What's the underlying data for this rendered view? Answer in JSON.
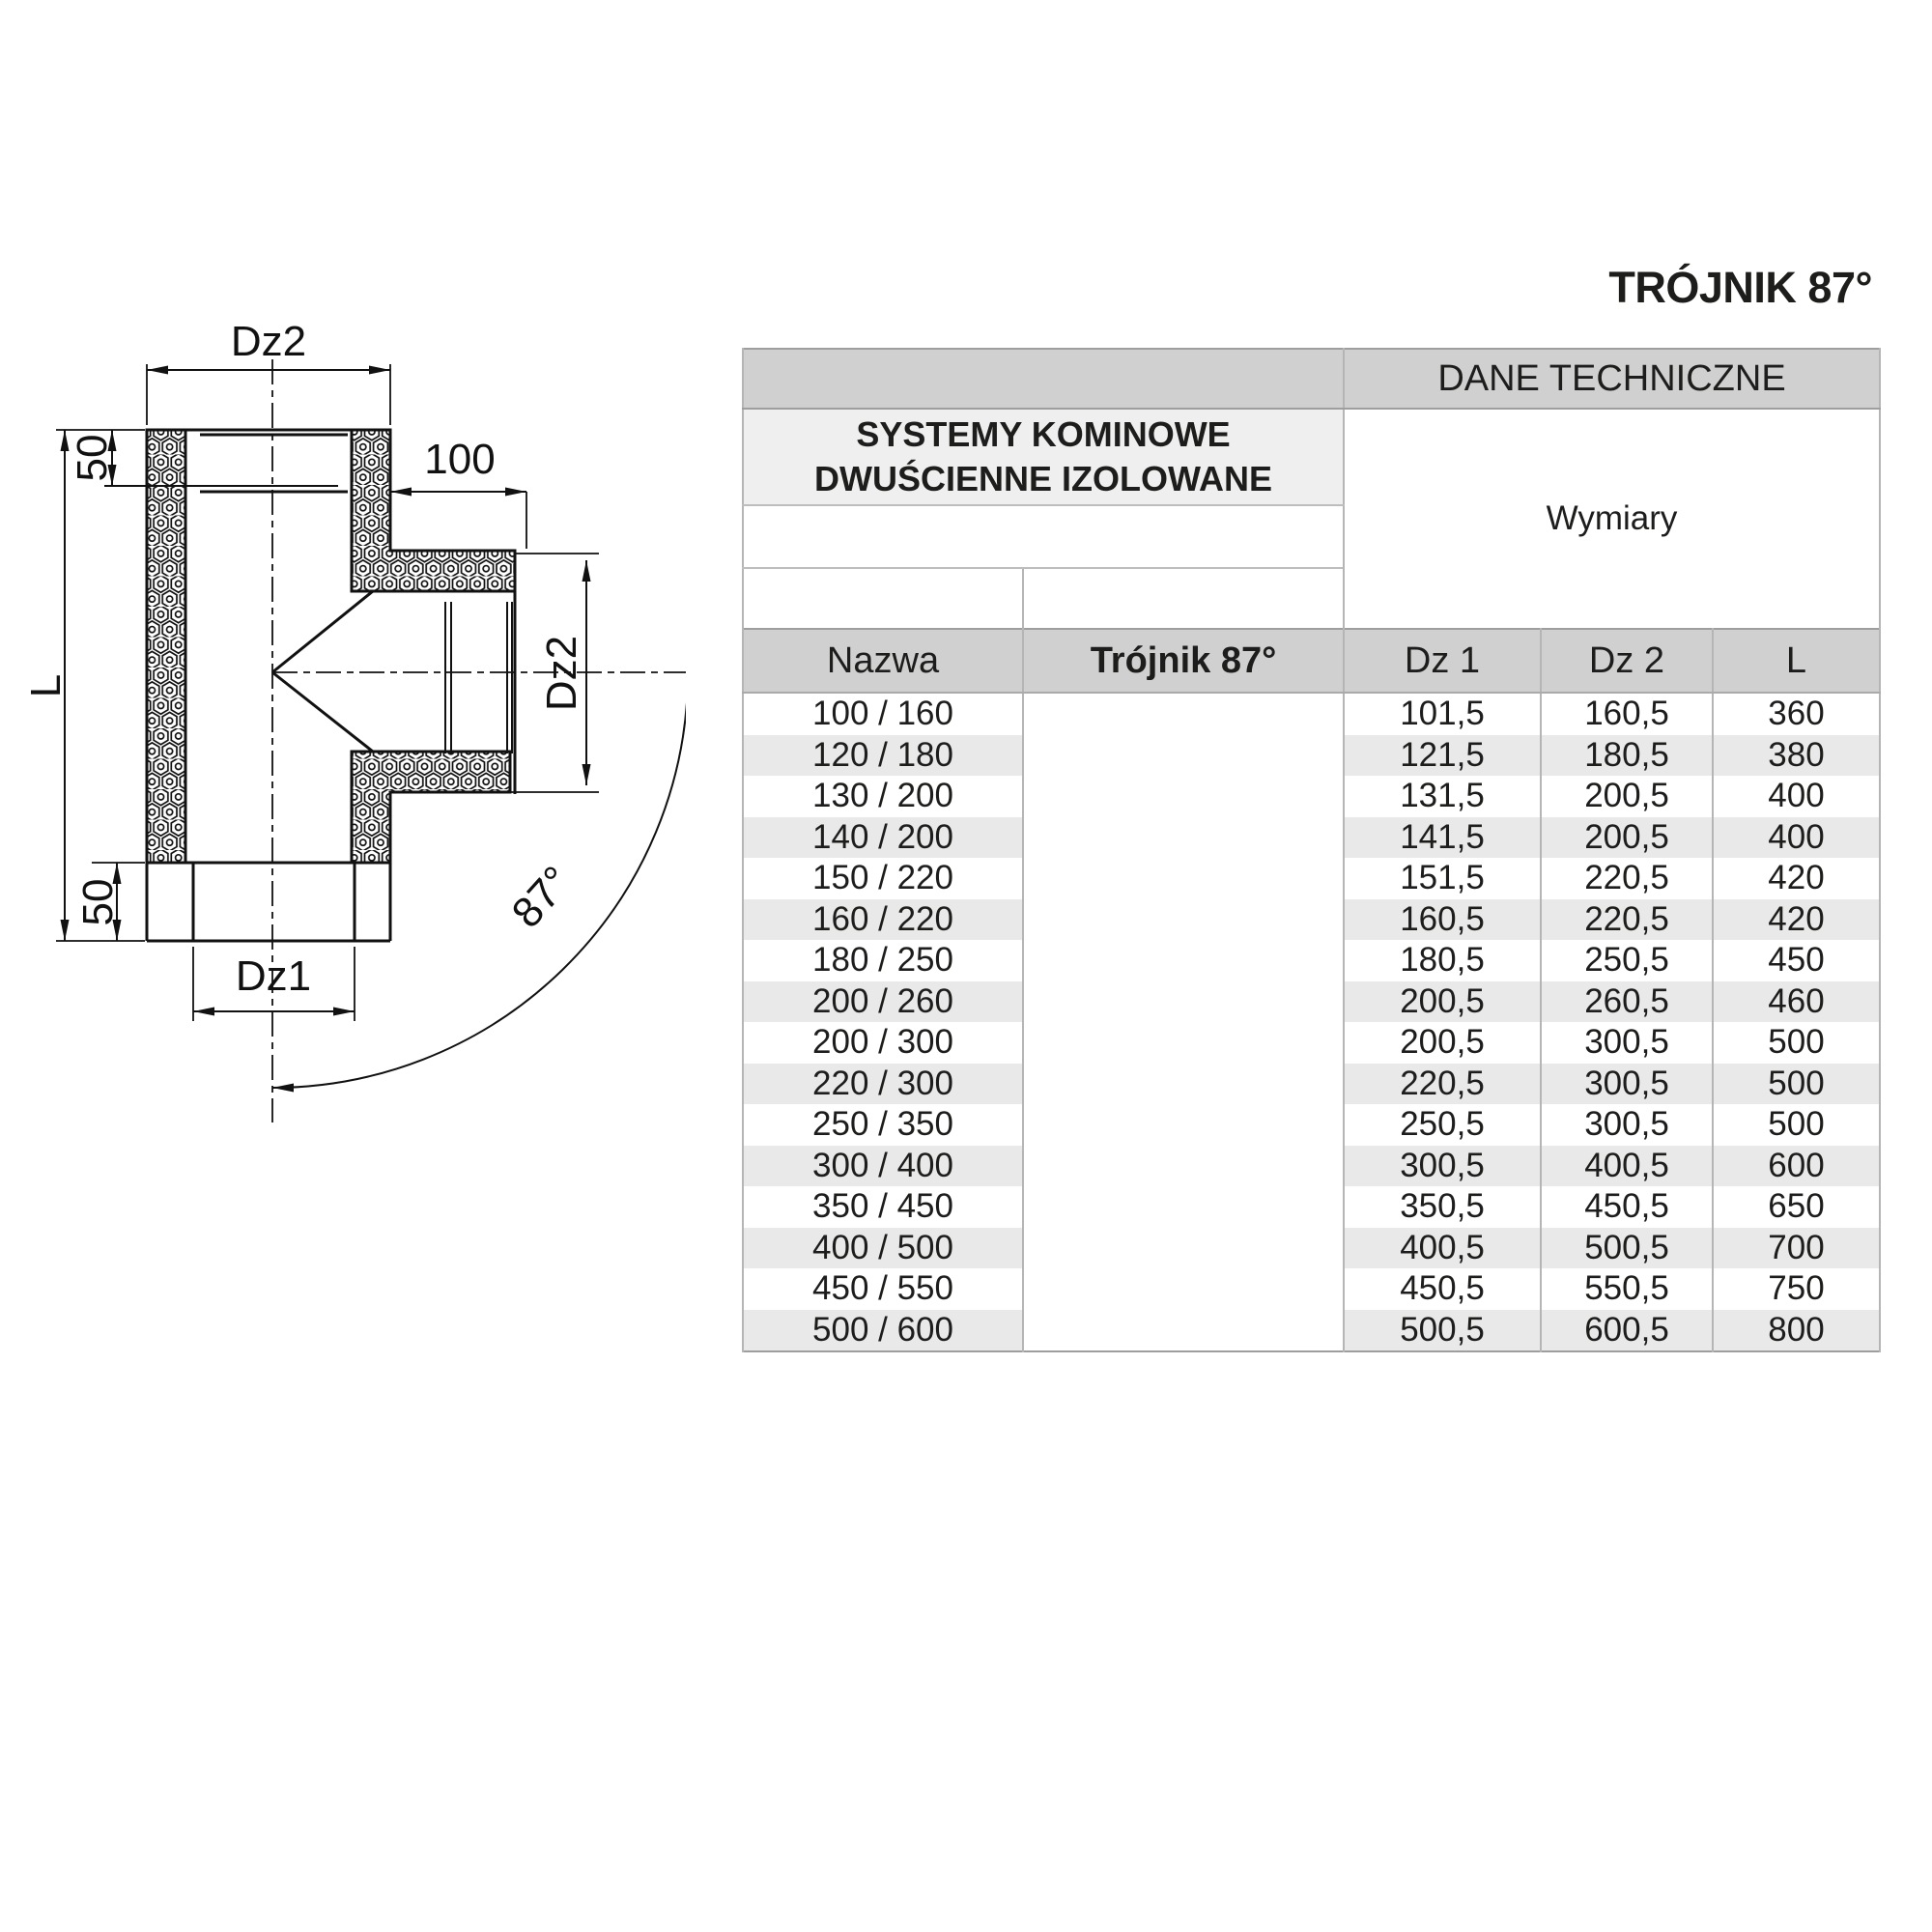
{
  "title": "TRÓJNIK 87°",
  "drawing": {
    "labels": {
      "dz2_top": "Dz2",
      "offset_top": "50",
      "length": "L",
      "branch_offset": "100",
      "dz2_branch": "Dz2",
      "offset_bottom": "50",
      "dz1_bottom": "Dz1",
      "angle": "87°"
    }
  },
  "table": {
    "dane_techniczne": "DANE TECHNICZNE",
    "product_group_line1": "SYSTEMY KOMINOWE",
    "product_group_line2": "DWUŚCIENNE IZOLOWANE",
    "wymiary": "Wymiary",
    "columns": {
      "nazwa": "Nazwa",
      "product": "Trójnik 87°",
      "dz1": "Dz 1",
      "dz2": "Dz 2",
      "l": "L"
    },
    "rows": [
      {
        "nazwa": "100 / 160",
        "dz1": "101,5",
        "dz2": "160,5",
        "l": "360"
      },
      {
        "nazwa": "120 / 180",
        "dz1": "121,5",
        "dz2": "180,5",
        "l": "380"
      },
      {
        "nazwa": "130 / 200",
        "dz1": "131,5",
        "dz2": "200,5",
        "l": "400"
      },
      {
        "nazwa": "140 / 200",
        "dz1": "141,5",
        "dz2": "200,5",
        "l": "400"
      },
      {
        "nazwa": "150 / 220",
        "dz1": "151,5",
        "dz2": "220,5",
        "l": "420"
      },
      {
        "nazwa": "160 / 220",
        "dz1": "160,5",
        "dz2": "220,5",
        "l": "420"
      },
      {
        "nazwa": "180 / 250",
        "dz1": "180,5",
        "dz2": "250,5",
        "l": "450"
      },
      {
        "nazwa": "200 / 260",
        "dz1": "200,5",
        "dz2": "260,5",
        "l": "460"
      },
      {
        "nazwa": "200 / 300",
        "dz1": "200,5",
        "dz2": "300,5",
        "l": "500"
      },
      {
        "nazwa": "220 / 300",
        "dz1": "220,5",
        "dz2": "300,5",
        "l": "500"
      },
      {
        "nazwa": "250 / 350",
        "dz1": "250,5",
        "dz2": "300,5",
        "l": "500"
      },
      {
        "nazwa": "300 / 400",
        "dz1": "300,5",
        "dz2": "400,5",
        "l": "600"
      },
      {
        "nazwa": "350 / 450",
        "dz1": "350,5",
        "dz2": "450,5",
        "l": "650"
      },
      {
        "nazwa": "400 / 500",
        "dz1": "400,5",
        "dz2": "500,5",
        "l": "700"
      },
      {
        "nazwa": "450 / 550",
        "dz1": "450,5",
        "dz2": "550,5",
        "l": "750"
      },
      {
        "nazwa": "500 / 600",
        "dz1": "500,5",
        "dz2": "600,5",
        "l": "800"
      }
    ]
  },
  "colors": {
    "band_gray": "#d0d0d0",
    "group_gray": "#efefef",
    "row_alt_gray": "#e9e9e9",
    "border_gray": "#9e9e9e",
    "line_black": "#111111",
    "text": "#1d1d1b"
  }
}
